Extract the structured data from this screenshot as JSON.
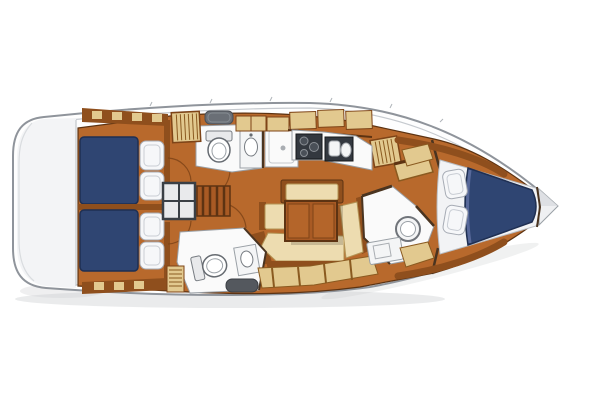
{
  "diagram": {
    "type": "yacht-interior-floor-plan",
    "view": "overhead",
    "bow_direction": "right"
  },
  "palette": {
    "paper": "#ffffff",
    "hull_white": "#fefefe",
    "transom_gray": "#f3f4f6",
    "tip_gray": "#eff0f2",
    "tip_shade": "#d9dce0",
    "shadow": "#c9cbce",
    "floor_wood": "#b8692c",
    "wood_dark": "#8f4f1d",
    "wood_mid": "#b4652a",
    "stairs_wood": "#a85a24",
    "berth_blue": "#2f4572",
    "berth_fold": "#58699a",
    "pillow_white": "#f6f7f9",
    "mattress_white": "#f2f3f5",
    "cushion_cream": "#eddcb0",
    "locker_tan": "#e2c98f",
    "fixture_white": "#fafafa",
    "fixture_light": "#f4f5f6",
    "porcelain": "#ffffff",
    "tank_gray": "#e8e9eb",
    "appliance_dark": "#33383f",
    "burner_gray": "#4a5058",
    "hatch_gray": "#6a6f76",
    "steel_dark": "#54585e",
    "engine_panel": "#e9eaec",
    "table_shadow": "#000000"
  },
  "components": [
    {
      "id": "stern-transom",
      "label": "stern transom swim platform"
    },
    {
      "id": "aft-cabin-port",
      "label": "aft double cabin with navy berth and two pillows"
    },
    {
      "id": "aft-cabin-starboard",
      "label": "aft double cabin with navy berth and two pillows"
    },
    {
      "id": "companionway",
      "label": "companionway steps and engine box"
    },
    {
      "id": "aft-head-port",
      "label": "head with toilet, sink and shower stall"
    },
    {
      "id": "aft-head-starboard",
      "label": "head with toilet, sink and step"
    },
    {
      "id": "galley",
      "label": "galley with stove and twin sinks"
    },
    {
      "id": "salon-dinette",
      "label": "U-shaped settee with folding table"
    },
    {
      "id": "chart-shelf",
      "label": "angled chart shelf"
    },
    {
      "id": "forward-head",
      "label": "forward head with round basin, vanity and seat"
    },
    {
      "id": "forward-cabin",
      "label": "V-berth bow cabin with navy mattress and two pillows"
    },
    {
      "id": "bow-locker",
      "label": "bow anchor locker"
    }
  ]
}
